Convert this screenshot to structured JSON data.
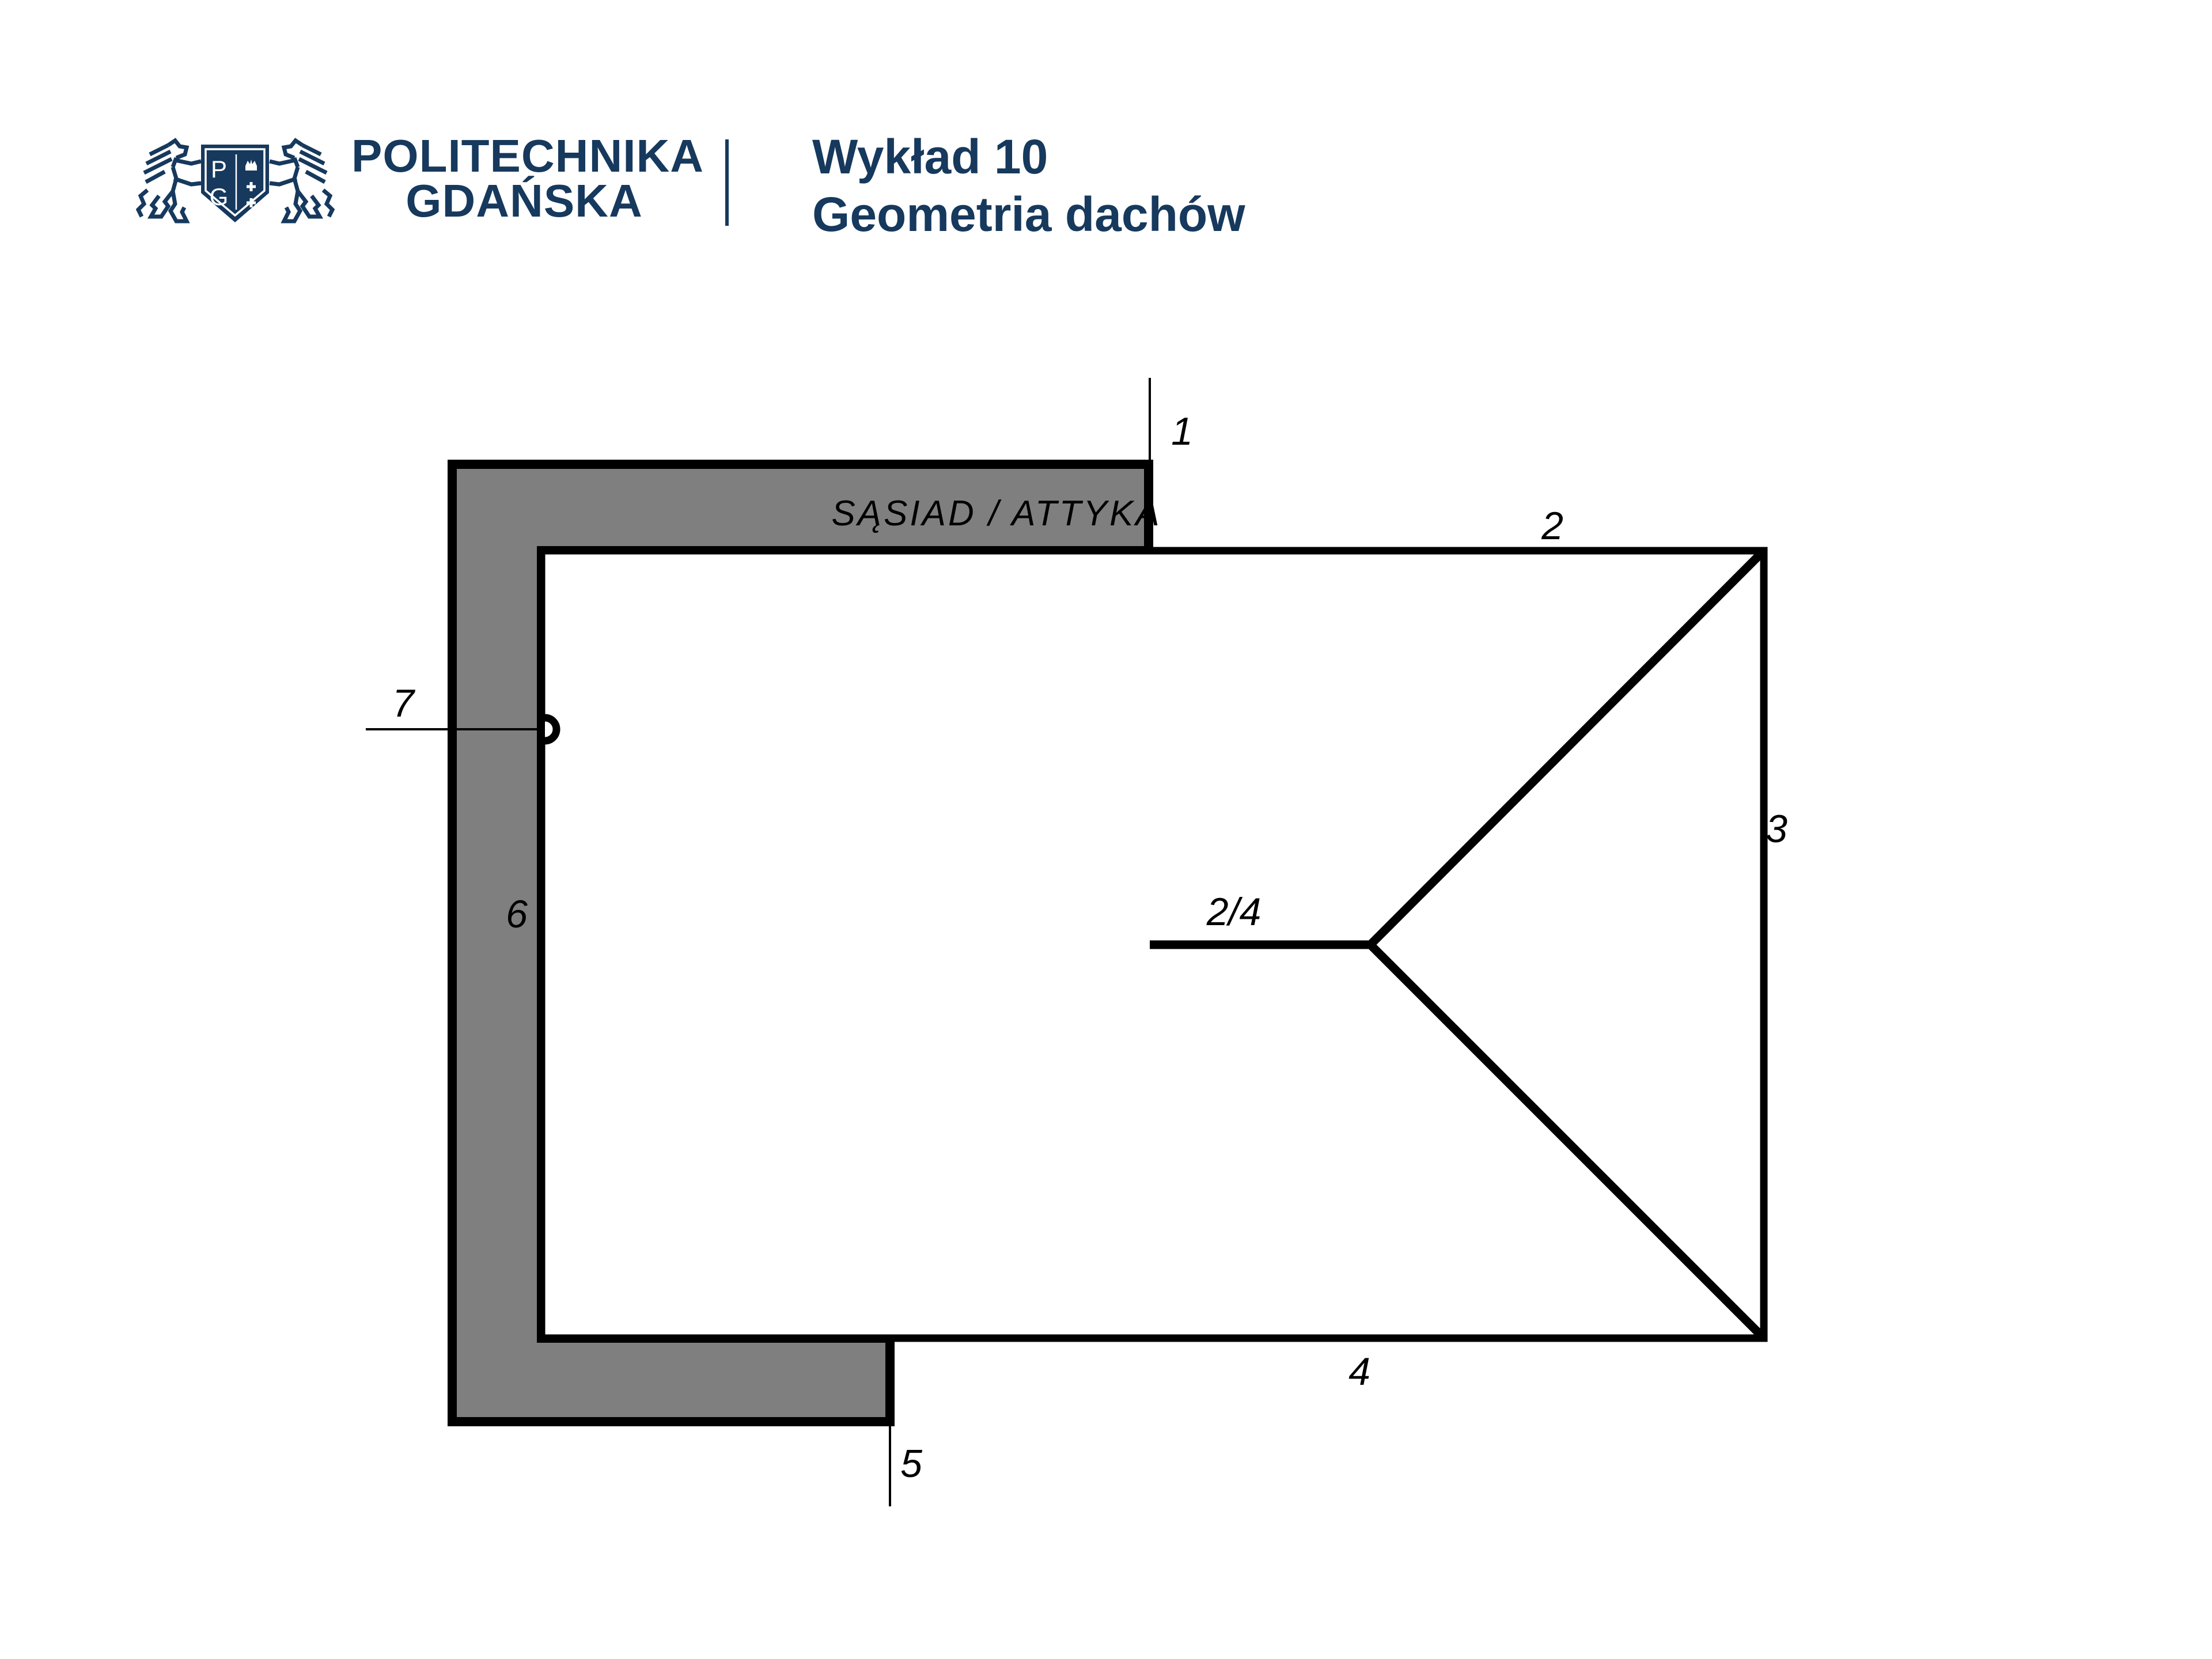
{
  "colors": {
    "navy": "#16395d",
    "region_gray": "#7f7f7f",
    "line_black": "#000000",
    "background": "#ffffff"
  },
  "header": {
    "logo": {
      "monogram_top": "P",
      "monogram_bottom": "G"
    },
    "university": {
      "line1": "POLITECHNIKA",
      "line2": "GDAŃSKA"
    },
    "lecture": {
      "line1": "Wykład 10",
      "line2": "Geometria dachów"
    }
  },
  "diagram": {
    "region_label": "SĄSIAD / ATTYKA",
    "labels": {
      "l1": "1",
      "l2": "2",
      "l3": "3",
      "l4": "4",
      "l5": "5",
      "l6": "6",
      "l7": "7",
      "ridge": "2/4"
    }
  }
}
